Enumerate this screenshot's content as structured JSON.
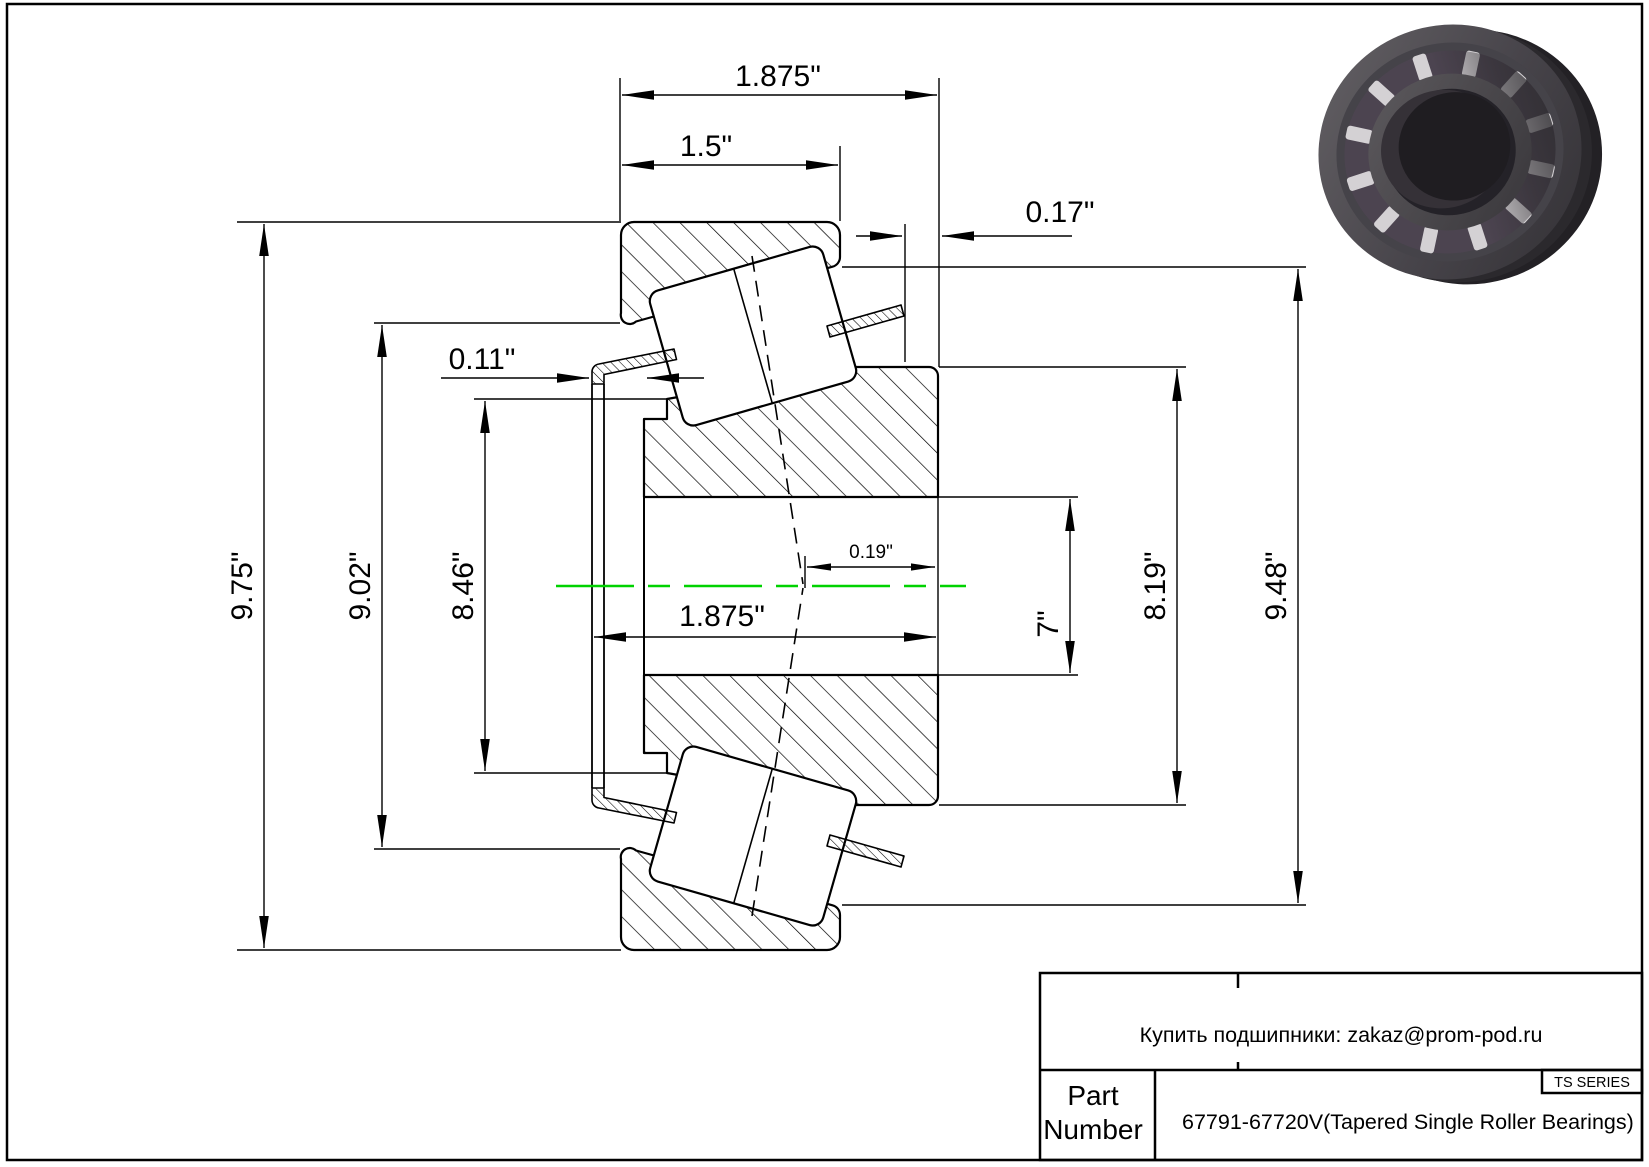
{
  "drawing": {
    "centerline_color": "#00d200",
    "dimensions": {
      "overall_width_top": "1.875\"",
      "cup_width": "1.5\"",
      "standout": "0.17\"",
      "sleeve_thickness": "0.11\"",
      "outer_diameter": "9.75\"",
      "dim_9_02": "9.02\"",
      "dim_8_46": "8.46\"",
      "apex_offset": "0.19\"",
      "overall_width_lower": "1.875\"",
      "bore_diameter": "7\"",
      "dim_8_19": "8.19\"",
      "dim_9_48": "9.48\""
    }
  },
  "title_block": {
    "contact_line": "Купить подшипники: zakaz@prom-pod.ru",
    "series_label": "TS SERIES",
    "part_label_line1": "Part",
    "part_label_line2": "Number",
    "part_number": "67791-67720V(Tapered Single Roller Bearings)"
  }
}
